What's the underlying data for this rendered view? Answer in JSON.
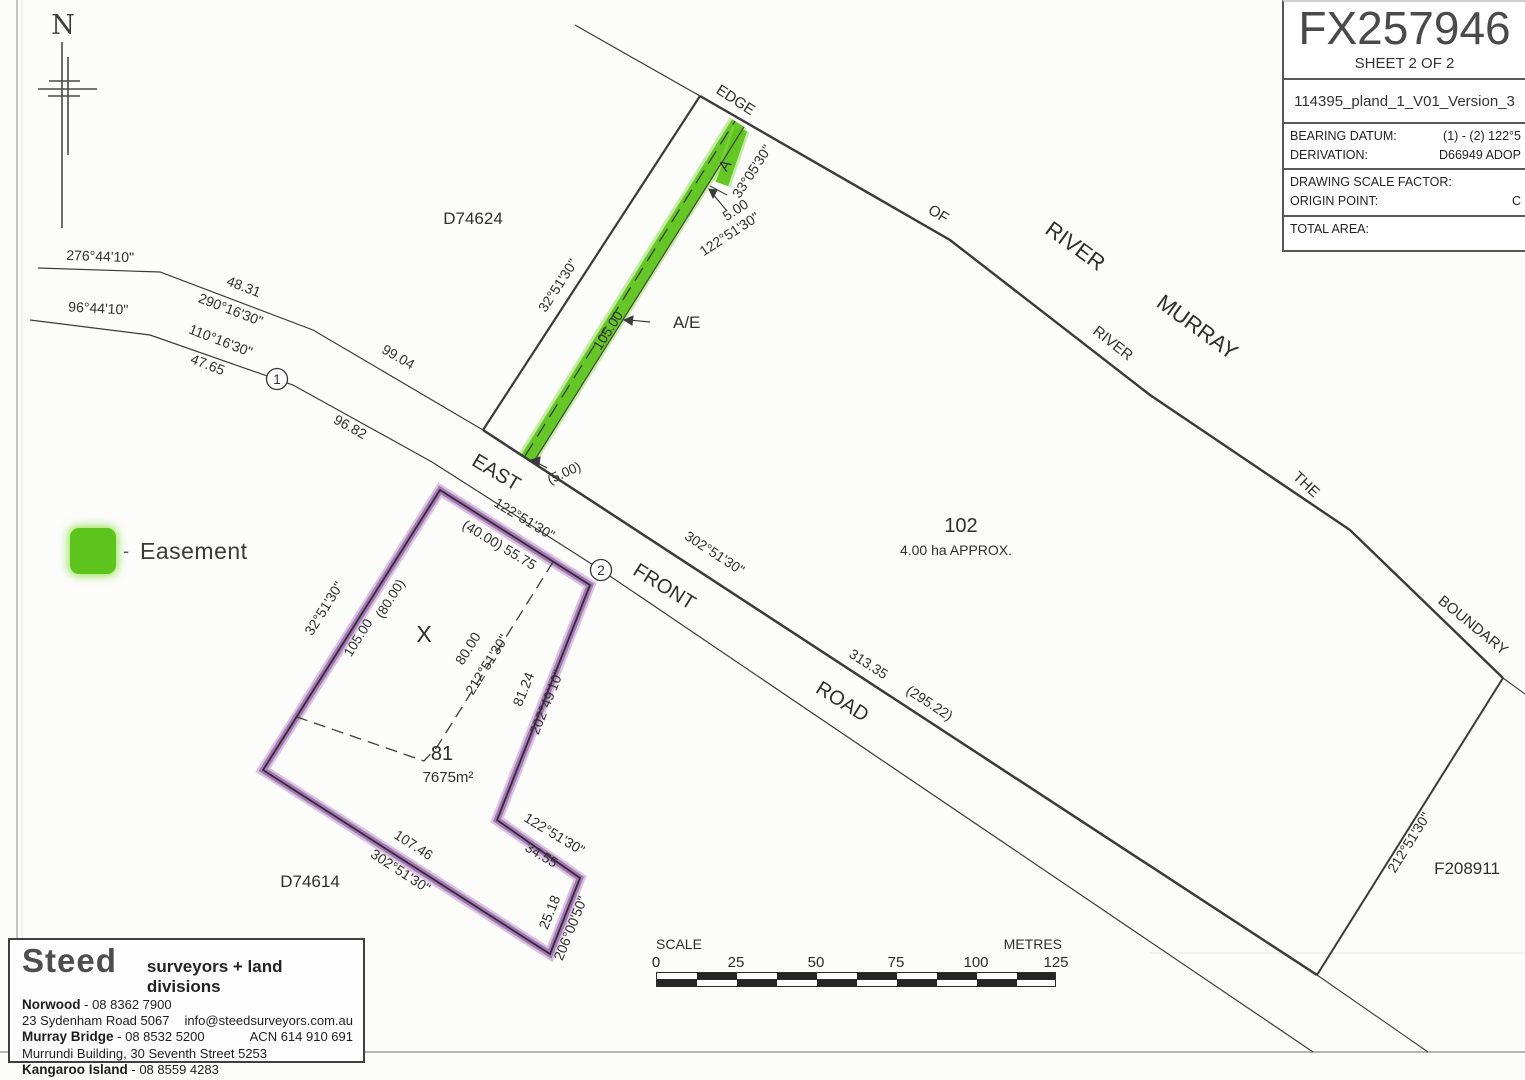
{
  "title_block": {
    "plan_number": "FX257946",
    "sheet": "SHEET 2 OF 2",
    "file_name": "114395_pland_1_V01_Version_3",
    "rows": {
      "bearing_datum_label": "BEARING DATUM:",
      "bearing_datum_value": "(1) - (2) 122°5",
      "derivation_label": "DERIVATION:",
      "derivation_value": "D66949 ADOP",
      "scale_factor_label": "DRAWING SCALE FACTOR:",
      "scale_factor_value": "",
      "origin_point_label": "ORIGIN POINT:",
      "origin_point_value": "C",
      "total_area_label": "TOTAL AREA:",
      "total_area_value": ""
    }
  },
  "north": {
    "label": "N"
  },
  "legend": {
    "dash": "-",
    "easement": "Easement"
  },
  "plan": {
    "parcels": {
      "d74624": "D74624",
      "d74614": "D74614",
      "f208911": "F208911",
      "lot102_number": "102",
      "lot102_area": "4.00 ha APPROX.",
      "lot81_number": "81",
      "lot81_area": "7675m²",
      "x_marker": "X"
    },
    "road_names": {
      "east": "EAST",
      "front": "FRONT",
      "road": "ROAD"
    },
    "river": {
      "edge": "EDGE",
      "of": "OF",
      "river_small": "RIVER",
      "river_big": "RIVER",
      "murray": "MURRAY",
      "the": "THE",
      "boundary": "BOUNDARY"
    },
    "points": {
      "p1": "1",
      "p2": "2"
    },
    "dims": {
      "n1_bearing": "276°44'10\"",
      "n2_dist": "48.31",
      "n2_bearing": "290°16'30\"",
      "n3_dist": "99.04",
      "s1_bearing": "96°44'10\"",
      "s2_bearing": "110°16'30\"",
      "s2_dist": "47.65",
      "s3_dist": "96.82",
      "d74624_bearing": "32°51'30\"",
      "ease_letter": "A",
      "ease_bearing": "33°05'30\"",
      "ease_len": "105.00",
      "ease_w_dist": "5.00",
      "ease_w_bearing": "122°51'30\"",
      "ease_w2": "(5.00)",
      "ease_tag": "A/E",
      "lot81_top_bearing": "122°51'30\"",
      "lot81_top_dist": "(40.00) 55.75",
      "road_bearing": "302°51'30\"",
      "road_dist": "313.35",
      "road_dist2": "(295.22)",
      "lot81_left_bearing": "32°51'30\"",
      "lot81_left_dist": "105.00",
      "lot81_left_dist2": "(80.00)",
      "int_dist": "80.00",
      "int_bearing": "212°51'30\"",
      "lot81_right_dist": "81.24",
      "lot81_right_bearing": "202°49'10\"",
      "lot81_bot_dist": "107.46",
      "lot81_bot_bearing": "302°51'30\"",
      "notch_bearing": "122°51'30\"",
      "notch_dist": "34.55",
      "se_dist": "25.18",
      "se_bearing": "206°00'50\"",
      "lot102_bearing": "212°51'30\""
    }
  },
  "scale": {
    "label": "SCALE",
    "unit": "METRES",
    "ticks": [
      "0",
      "25",
      "50",
      "75",
      "100",
      "125"
    ]
  },
  "surveyor": {
    "brand": "Steed",
    "tagline": "surveyors + land divisions",
    "norwood_name": "Norwood",
    "norwood_phone": "- 08 8362 7900",
    "norwood_addr": "23 Sydenham Road 5067",
    "email": "info@steedsurveyors.com.au",
    "mb_name": "Murray Bridge",
    "mb_phone": "- 08 8532 5200",
    "acn": "ACN 614 910 691",
    "mb_addr": "Murrundi Building, 30 Seventh Street 5253",
    "ki_name": "Kangaroo Island",
    "ki_phone": "- 08 8559 4283",
    "ref_label": "REFERENCE:",
    "ref_value": "13023F2.0",
    "date": "19/07/22",
    "initials": "FJT"
  },
  "colors": {
    "easement_green": "#5cc41c",
    "lot_purple": "#9a63ae",
    "ink": "#333333"
  }
}
